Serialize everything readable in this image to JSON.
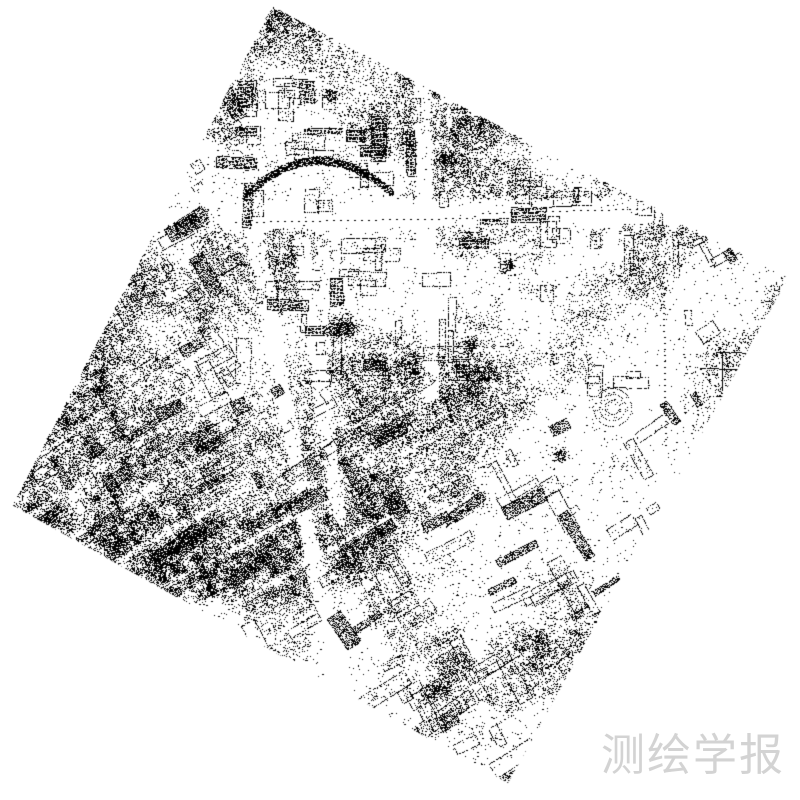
{
  "page": {
    "width": 800,
    "height": 800,
    "background": "#ffffff"
  },
  "figure": {
    "dot_color": "#000000",
    "background": "#ffffff",
    "generation": {
      "seed": 20240613,
      "corners": [
        [
          272,
          6
        ],
        [
          788,
          278
        ],
        [
          508,
          783
        ],
        [
          12,
          505
        ]
      ],
      "base": {
        "offset": 0.015,
        "gain": 0.46,
        "thresh": 0.36,
        "mult": 2.4
      },
      "sparse_zones": [
        {
          "cx": 660,
          "cy": 395,
          "rx": 150,
          "ry": 115,
          "rot": -35,
          "f": 0.28
        },
        {
          "cx": 540,
          "cy": 300,
          "rx": 80,
          "ry": 55,
          "rot": -30,
          "f": 0.55
        }
      ],
      "dense_zones": [
        {
          "cx": 430,
          "cy": 650,
          "rx": 250,
          "ry": 115,
          "rot": -22,
          "f": 1.35
        },
        {
          "cx": 150,
          "cy": 480,
          "rx": 135,
          "ry": 160,
          "rot": 0,
          "f": 1.3
        },
        {
          "cx": 300,
          "cy": 120,
          "rx": 150,
          "ry": 100,
          "rot": 25,
          "f": 1.15
        }
      ],
      "street_diag": {
        "angle": -30,
        "spacing": 46,
        "width": 0.11,
        "strength": 0.8
      },
      "street_perp": {
        "angle": 60,
        "spacing": 118,
        "width": 0.055,
        "strength": 0.5
      },
      "axis_box": [
        235,
        60,
        690,
        385
      ],
      "axis_spacing": [
        56,
        50
      ],
      "axis_width": 0.09,
      "axis_strength": 0.55,
      "corridors": [
        {
          "a": [
            228,
            217
          ],
          "b": [
            672,
            211
          ],
          "w": 11
        },
        {
          "a": [
            672,
            211
          ],
          "b": [
            756,
            248
          ],
          "w": 8
        },
        {
          "a": [
            421,
            78
          ],
          "b": [
            430,
            392
          ],
          "w": 7
        },
        {
          "a": [
            253,
            228
          ],
          "b": [
            312,
            556
          ],
          "w": 6
        },
        {
          "a": [
            312,
            556
          ],
          "b": [
            346,
            694
          ],
          "w": 7
        },
        {
          "a": [
            301,
            242
          ],
          "b": [
            338,
            516
          ],
          "w": 5
        }
      ],
      "buildings": {
        "count": 300
      },
      "blobs": [
        [
          341,
          327,
          16
        ],
        [
          118,
          546,
          11
        ],
        [
          436,
          688,
          13
        ],
        [
          268,
          657,
          11
        ],
        [
          613,
          129,
          12
        ],
        [
          663,
          196,
          9
        ],
        [
          508,
          266,
          9
        ],
        [
          374,
          516,
          9
        ],
        [
          446,
          159,
          11
        ],
        [
          96,
          499,
          8
        ],
        [
          540,
          640,
          12
        ],
        [
          205,
          430,
          9
        ],
        [
          470,
          345,
          10
        ],
        [
          560,
          455,
          9
        ],
        [
          330,
          95,
          9
        ]
      ],
      "ring": {
        "cx": 612,
        "cy": 407,
        "radii": [
          7,
          13,
          19
        ]
      },
      "arc": {
        "p0": [
          243,
          197
        ],
        "c": [
          315,
          126
        ],
        "p1": [
          392,
          193
        ],
        "halfwidth": 4
      },
      "dash_lines": [
        {
          "a": [
            482,
            213
          ],
          "b": [
            700,
            207
          ],
          "step": 7
        },
        {
          "a": [
            235,
            222
          ],
          "b": [
            470,
            218
          ],
          "step": 7
        },
        {
          "a": [
            663,
            295
          ],
          "b": [
            665,
            445
          ],
          "step": 6
        }
      ],
      "solid_lines": [
        {
          "a": [
            716,
            352
          ],
          "b": [
            768,
            353
          ]
        },
        {
          "a": [
            700,
            368
          ],
          "b": [
            738,
            369
          ]
        },
        {
          "a": [
            722,
            352
          ],
          "b": [
            722,
            390
          ]
        }
      ]
    }
  },
  "watermark": {
    "text": "测绘学报",
    "color": "#d3d3d3"
  }
}
